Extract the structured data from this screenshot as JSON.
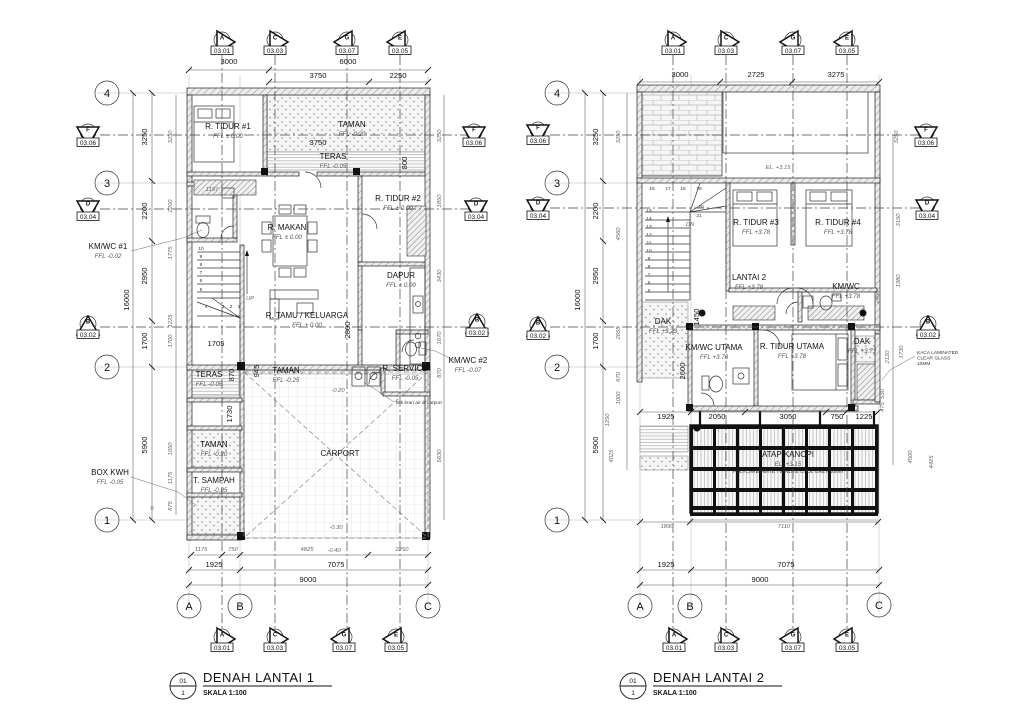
{
  "plan1": {
    "title": {
      "num": "01",
      "den": "1",
      "label": "DENAH LANTAI 1",
      "scale": "SKALA 1:100"
    },
    "grid_bubbles": [
      {
        "t": "4",
        "x": 107,
        "y": 93
      },
      {
        "t": "3",
        "x": 107,
        "y": 183
      },
      {
        "t": "2",
        "x": 107,
        "y": 367
      },
      {
        "t": "1",
        "x": 107,
        "y": 520
      },
      {
        "t": "A",
        "x": 189,
        "y": 606
      },
      {
        "t": "B",
        "x": 240,
        "y": 606
      },
      {
        "t": "C",
        "x": 428,
        "y": 606
      }
    ],
    "section_markers": [
      {
        "l": "A",
        "s": "03.01",
        "x": 222,
        "y": 43,
        "d": "r"
      },
      {
        "l": "C",
        "s": "03.03",
        "x": 275,
        "y": 43,
        "d": "r"
      },
      {
        "l": "G",
        "s": "03.07",
        "x": 347,
        "y": 43,
        "d": "l"
      },
      {
        "l": "E",
        "s": "03.05",
        "x": 400,
        "y": 43,
        "d": "l"
      },
      {
        "l": "A",
        "s": "03.01",
        "x": 222,
        "y": 640,
        "d": "r"
      },
      {
        "l": "C",
        "s": "03.03",
        "x": 275,
        "y": 640,
        "d": "r"
      },
      {
        "l": "G",
        "s": "03.07",
        "x": 344,
        "y": 640,
        "d": "l"
      },
      {
        "l": "E",
        "s": "03.05",
        "x": 396,
        "y": 640,
        "d": "l"
      },
      {
        "l": "F",
        "s": "03.06",
        "x": 88,
        "y": 135,
        "d": "d"
      },
      {
        "l": "D",
        "s": "03.04",
        "x": 88,
        "y": 209,
        "d": "d"
      },
      {
        "l": "B",
        "s": "03.02",
        "x": 88,
        "y": 327,
        "d": "u"
      },
      {
        "l": "F",
        "s": "03.06",
        "x": 474,
        "y": 135,
        "d": "d"
      },
      {
        "l": "D",
        "s": "03.04",
        "x": 476,
        "y": 209,
        "d": "d"
      },
      {
        "l": "B",
        "s": "03.02",
        "x": 477,
        "y": 325,
        "d": "u"
      }
    ],
    "rooms": [
      {
        "name": "R. TIDUR #1",
        "level": "FFL ± 0.00",
        "x": 228,
        "y": 129
      },
      {
        "name": "TAMAN",
        "level": "FFL -0.20",
        "x": 352,
        "y": 127
      },
      {
        "name": "TERAS",
        "level": "FFL -0.05",
        "x": 333,
        "y": 159
      },
      {
        "name": "R. MAKAN",
        "level": "FFL ± 0.00",
        "x": 287,
        "y": 230
      },
      {
        "name": "R. TIDUR #2",
        "level": "FFL ± 0.00",
        "x": 398,
        "y": 201
      },
      {
        "name": "DAPUR",
        "level": "FFL ± 0.00",
        "x": 401,
        "y": 278
      },
      {
        "name": "R. TAMU / KELUARGA",
        "level": "FFL ± 0.00",
        "x": 307,
        "y": 318
      },
      {
        "name": "KM/WC #1",
        "level": "FFL -0.02",
        "x": 108,
        "y": 249
      },
      {
        "name": "KM/WC #2",
        "level": "FFL -0.07",
        "x": 468,
        "y": 363
      },
      {
        "name": "R. SERVICE",
        "level": "FFL -0.05",
        "x": 405,
        "y": 371
      },
      {
        "name": "TAMAN",
        "level": "FFL -0.25",
        "x": 286,
        "y": 373
      },
      {
        "name": "TERAS",
        "level": "FFL -0.05",
        "x": 209,
        "y": 377
      },
      {
        "name": "TAMAN",
        "level": "FFL -0.20",
        "x": 214,
        "y": 447
      },
      {
        "name": "T. SAMPAH",
        "level": "FFL -0.05",
        "x": 214,
        "y": 483
      },
      {
        "name": "BOX KWH",
        "level": "FFL -0.05",
        "x": 110,
        "y": 475
      },
      {
        "name": "CARPORT",
        "level": "",
        "x": 340,
        "y": 456
      }
    ],
    "dims": [
      {
        "t": "3000",
        "x": 229,
        "y": 64
      },
      {
        "t": "6000",
        "x": 348,
        "y": 64
      },
      {
        "t": "3750",
        "x": 318,
        "y": 78
      },
      {
        "t": "2250",
        "x": 398,
        "y": 78
      },
      {
        "t": "3750",
        "x": 318,
        "y": 145
      },
      {
        "t": "1705",
        "x": 216,
        "y": 346
      },
      {
        "t": "1925",
        "x": 214,
        "y": 567
      },
      {
        "t": "7075",
        "x": 336,
        "y": 567
      },
      {
        "t": "9000",
        "x": 308,
        "y": 582
      },
      {
        "t": "3250",
        "x": 147,
        "y": 137,
        "r": 1
      },
      {
        "t": "2200",
        "x": 147,
        "y": 211,
        "r": 1
      },
      {
        "t": "2950",
        "x": 147,
        "y": 276,
        "r": 1
      },
      {
        "t": "1700",
        "x": 147,
        "y": 341,
        "r": 1
      },
      {
        "t": "5900",
        "x": 147,
        "y": 445,
        "r": 1
      },
      {
        "t": "16000",
        "x": 129,
        "y": 300,
        "r": 1
      },
      {
        "t": "870",
        "x": 234,
        "y": 375,
        "r": 1
      },
      {
        "t": "945",
        "x": 259,
        "y": 371,
        "r": 1
      },
      {
        "t": "1730",
        "x": 232,
        "y": 414,
        "r": 1
      },
      {
        "t": "2800",
        "x": 350,
        "y": 330,
        "r": 1
      },
      {
        "t": "800",
        "x": 407,
        "y": 163,
        "r": 1
      },
      {
        "t": "1197",
        "x": 212,
        "y": 191,
        "c": "i"
      },
      {
        "t": "-0.20",
        "x": 338,
        "y": 392,
        "c": "i"
      },
      {
        "t": "-0.30",
        "x": 336,
        "y": 529,
        "c": "i"
      },
      {
        "t": "-0.40",
        "x": 334,
        "y": 552,
        "c": "i"
      },
      {
        "t": "0",
        "x": 152,
        "y": 510,
        "c": "i"
      },
      {
        "t": "3250",
        "x": 172,
        "y": 137,
        "r": 1,
        "c": "i"
      },
      {
        "t": "2200",
        "x": 172,
        "y": 206,
        "r": 1,
        "c": "i"
      },
      {
        "t": "1775",
        "x": 172,
        "y": 253,
        "r": 1,
        "c": "i"
      },
      {
        "t": "1225",
        "x": 172,
        "y": 321,
        "r": 1,
        "c": "i"
      },
      {
        "t": "1700",
        "x": 172,
        "y": 341,
        "r": 1,
        "c": "i"
      },
      {
        "t": "1050",
        "x": 172,
        "y": 449,
        "r": 1,
        "c": "i"
      },
      {
        "t": "1175",
        "x": 172,
        "y": 478,
        "r": 1,
        "c": "i"
      },
      {
        "t": "875",
        "x": 172,
        "y": 506,
        "r": 1,
        "c": "i"
      },
      {
        "t": "1175",
        "x": 201,
        "y": 551,
        "c": "i"
      },
      {
        "t": "750",
        "x": 233,
        "y": 551,
        "c": "i"
      },
      {
        "t": "4825",
        "x": 307,
        "y": 551,
        "c": "i"
      },
      {
        "t": "2250",
        "x": 402,
        "y": 551,
        "c": "i"
      },
      {
        "t": "3250",
        "x": 441,
        "y": 136,
        "r": 1,
        "c": "i"
      },
      {
        "t": "1850",
        "x": 441,
        "y": 201,
        "r": 1,
        "c": "i"
      },
      {
        "t": "3430",
        "x": 441,
        "y": 276,
        "r": 1,
        "c": "i"
      },
      {
        "t": "1670",
        "x": 441,
        "y": 338,
        "r": 1,
        "c": "i"
      },
      {
        "t": "870",
        "x": 441,
        "y": 373,
        "r": 1,
        "c": "i"
      },
      {
        "t": "5630",
        "x": 441,
        "y": 456,
        "r": 1,
        "c": "i"
      },
      {
        "t": "10",
        "x": 201,
        "y": 250,
        "c": "tiny"
      },
      {
        "t": "9",
        "x": 201,
        "y": 258,
        "c": "tiny"
      },
      {
        "t": "8",
        "x": 201,
        "y": 266,
        "c": "tiny"
      },
      {
        "t": "7",
        "x": 201,
        "y": 274,
        "c": "tiny"
      },
      {
        "t": "6",
        "x": 201,
        "y": 282,
        "c": "tiny"
      },
      {
        "t": "5",
        "x": 201,
        "y": 291,
        "c": "tiny"
      },
      {
        "t": "4",
        "x": 206,
        "y": 308,
        "c": "tiny"
      },
      {
        "t": "3",
        "x": 223,
        "y": 308,
        "c": "tiny"
      },
      {
        "t": "2",
        "x": 231,
        "y": 308,
        "c": "tiny"
      },
      {
        "t": "1",
        "x": 239,
        "y": 308,
        "c": "tiny"
      },
      {
        "t": "UP",
        "x": 250,
        "y": 300,
        "c": "i"
      }
    ],
    "notes": [
      {
        "lines": [
          "titik kran air di carport"
        ],
        "x": 396,
        "y": 404,
        "a": "start"
      }
    ]
  },
  "plan2": {
    "title": {
      "num": "01",
      "den": "1",
      "label": "DENAH LANTAI 2",
      "scale": "SKALA 1:100"
    },
    "grid_bubbles": [
      {
        "t": "4",
        "x": 557,
        "y": 93
      },
      {
        "t": "3",
        "x": 557,
        "y": 183
      },
      {
        "t": "2",
        "x": 557,
        "y": 367
      },
      {
        "t": "1",
        "x": 557,
        "y": 520
      },
      {
        "t": "A",
        "x": 640,
        "y": 606
      },
      {
        "t": "B",
        "x": 690,
        "y": 606
      },
      {
        "t": "C",
        "x": 879,
        "y": 605
      }
    ],
    "section_markers": [
      {
        "l": "A",
        "s": "03.01",
        "x": 673,
        "y": 43,
        "d": "r"
      },
      {
        "l": "C",
        "s": "03.03",
        "x": 726,
        "y": 43,
        "d": "r"
      },
      {
        "l": "G",
        "s": "03.07",
        "x": 793,
        "y": 43,
        "d": "l"
      },
      {
        "l": "E",
        "s": "03.05",
        "x": 847,
        "y": 43,
        "d": "l"
      },
      {
        "l": "A",
        "s": "03.01",
        "x": 674,
        "y": 640,
        "d": "r"
      },
      {
        "l": "C",
        "s": "03.03",
        "x": 726,
        "y": 640,
        "d": "r"
      },
      {
        "l": "G",
        "s": "03.07",
        "x": 793,
        "y": 640,
        "d": "l"
      },
      {
        "l": "E",
        "s": "03.05",
        "x": 847,
        "y": 640,
        "d": "l"
      },
      {
        "l": "F",
        "s": "03.06",
        "x": 538,
        "y": 133,
        "d": "d"
      },
      {
        "l": "D",
        "s": "03.04",
        "x": 538,
        "y": 208,
        "d": "d"
      },
      {
        "l": "B",
        "s": "03.02",
        "x": 538,
        "y": 328,
        "d": "u"
      },
      {
        "l": "F",
        "s": "03.06",
        "x": 926,
        "y": 135,
        "d": "d"
      },
      {
        "l": "D",
        "s": "03.04",
        "x": 927,
        "y": 208,
        "d": "d"
      },
      {
        "l": "B",
        "s": "03.02",
        "x": 928,
        "y": 327,
        "d": "u"
      }
    ],
    "rooms": [
      {
        "name": "R. TIDUR #3",
        "level": "FFL +3.78",
        "x": 756,
        "y": 225
      },
      {
        "name": "R. TIDUR #4",
        "level": "FFL +3.78",
        "x": 838,
        "y": 225
      },
      {
        "name": "LANTAI 2",
        "level": "FFL +3.78",
        "x": 749,
        "y": 280
      },
      {
        "name": "KM/WC",
        "level": "FFL +3.78",
        "x": 846,
        "y": 289
      },
      {
        "name": "DAK",
        "level": "FFL +3.23",
        "x": 663,
        "y": 324
      },
      {
        "name": "KM/WC UTAMA",
        "level": "FFL +3.78",
        "x": 714,
        "y": 350
      },
      {
        "name": "R. TIDUR UTAMA",
        "level": "FFL +3.78",
        "x": 792,
        "y": 349
      },
      {
        "name": "DAK",
        "level": "FFL +3.73",
        "x": 862,
        "y": 344
      },
      {
        "name": "ATAP KANOPI",
        "level": "EL. +3.15",
        "x": 788,
        "y": 457
      }
    ],
    "dims": [
      {
        "t": "3000",
        "x": 680,
        "y": 77
      },
      {
        "t": "2725",
        "x": 756,
        "y": 77
      },
      {
        "t": "3275",
        "x": 836,
        "y": 77
      },
      {
        "t": "1925",
        "x": 666,
        "y": 419
      },
      {
        "t": "2050",
        "x": 717,
        "y": 419
      },
      {
        "t": "3050",
        "x": 788,
        "y": 419
      },
      {
        "t": "750",
        "x": 837,
        "y": 419
      },
      {
        "t": "1225",
        "x": 864,
        "y": 419
      },
      {
        "t": "1890",
        "x": 667,
        "y": 528,
        "c": "i"
      },
      {
        "t": "7110",
        "x": 784,
        "y": 528,
        "c": "i"
      },
      {
        "t": "1925",
        "x": 666,
        "y": 567
      },
      {
        "t": "7075",
        "x": 786,
        "y": 567
      },
      {
        "t": "9000",
        "x": 760,
        "y": 582
      },
      {
        "t": "3250",
        "x": 598,
        "y": 137,
        "r": 1
      },
      {
        "t": "2200",
        "x": 598,
        "y": 211,
        "r": 1
      },
      {
        "t": "2950",
        "x": 598,
        "y": 276,
        "r": 1
      },
      {
        "t": "1700",
        "x": 598,
        "y": 341,
        "r": 1
      },
      {
        "t": "5900",
        "x": 598,
        "y": 445,
        "r": 1
      },
      {
        "t": "16000",
        "x": 580,
        "y": 300,
        "r": 1
      },
      {
        "t": "1450",
        "x": 699,
        "y": 317,
        "r": 1
      },
      {
        "t": "2600",
        "x": 685,
        "y": 371,
        "r": 1
      },
      {
        "t": "EL. +3.15",
        "x": 778,
        "y": 169,
        "c": "i"
      },
      {
        "t": "3250",
        "x": 620,
        "y": 137,
        "r": 1,
        "c": "i"
      },
      {
        "t": "4560",
        "x": 620,
        "y": 234,
        "r": 1,
        "c": "i"
      },
      {
        "t": "2655",
        "x": 620,
        "y": 333,
        "r": 1,
        "c": "i"
      },
      {
        "t": "670",
        "x": 620,
        "y": 377,
        "r": 1,
        "c": "i"
      },
      {
        "t": "1000",
        "x": 620,
        "y": 398,
        "r": 1,
        "c": "i"
      },
      {
        "t": "1250",
        "x": 609,
        "y": 420,
        "r": 1,
        "c": "i"
      },
      {
        "t": "4025",
        "x": 613,
        "y": 456,
        "r": 1,
        "c": "i"
      },
      {
        "t": "3250",
        "x": 898,
        "y": 137,
        "r": 1,
        "c": "i"
      },
      {
        "t": "3150",
        "x": 900,
        "y": 220,
        "r": 1,
        "c": "i"
      },
      {
        "t": "1380",
        "x": 900,
        "y": 281,
        "r": 1,
        "c": "i"
      },
      {
        "t": "2450",
        "x": 879,
        "y": 297,
        "r": 1,
        "c": "i"
      },
      {
        "t": "2120",
        "x": 889,
        "y": 357,
        "r": 1,
        "c": "i"
      },
      {
        "t": "1730",
        "x": 903,
        "y": 352,
        "r": 1,
        "c": "i"
      },
      {
        "t": "530",
        "x": 884,
        "y": 394,
        "r": 1,
        "c": "i"
      },
      {
        "t": "475",
        "x": 884,
        "y": 407,
        "r": 1,
        "c": "i"
      },
      {
        "t": "4500",
        "x": 912,
        "y": 457,
        "r": 1,
        "c": "i"
      },
      {
        "t": "4425",
        "x": 933,
        "y": 462,
        "r": 1,
        "c": "i"
      },
      {
        "t": "16",
        "x": 652,
        "y": 190,
        "c": "tiny"
      },
      {
        "t": "17",
        "x": 668,
        "y": 190,
        "c": "tiny"
      },
      {
        "t": "18",
        "x": 683,
        "y": 190,
        "c": "tiny"
      },
      {
        "t": "19",
        "x": 699,
        "y": 190,
        "c": "tiny"
      },
      {
        "t": "20",
        "x": 701,
        "y": 208,
        "c": "tiny"
      },
      {
        "t": "21",
        "x": 699,
        "y": 217,
        "c": "tiny"
      },
      {
        "t": "DN",
        "x": 690,
        "y": 226,
        "c": "i"
      },
      {
        "t": "15",
        "x": 649,
        "y": 212,
        "c": "tiny"
      },
      {
        "t": "14",
        "x": 649,
        "y": 220,
        "c": "tiny"
      },
      {
        "t": "13",
        "x": 649,
        "y": 228,
        "c": "tiny"
      },
      {
        "t": "12",
        "x": 649,
        "y": 236,
        "c": "tiny"
      },
      {
        "t": "11",
        "x": 649,
        "y": 244,
        "c": "tiny"
      },
      {
        "t": "10",
        "x": 649,
        "y": 252,
        "c": "tiny"
      },
      {
        "t": "9",
        "x": 649,
        "y": 260,
        "c": "tiny"
      },
      {
        "t": "8",
        "x": 649,
        "y": 268,
        "c": "tiny"
      },
      {
        "t": "7",
        "x": 649,
        "y": 276,
        "c": "tiny"
      },
      {
        "t": "6",
        "x": 649,
        "y": 284,
        "c": "tiny"
      },
      {
        "t": "5",
        "x": 649,
        "y": 292,
        "c": "tiny"
      }
    ],
    "notes": [
      {
        "lines": [
          "POLYCARBONATE TWINLITE COOL GREY 10mm"
        ],
        "x": 788,
        "y": 473,
        "a": "middle"
      },
      {
        "lines": [
          "KACA LAMINATED",
          "CLEAR GLASS",
          "10MM"
        ],
        "x": 917,
        "y": 354,
        "a": "start"
      }
    ]
  }
}
